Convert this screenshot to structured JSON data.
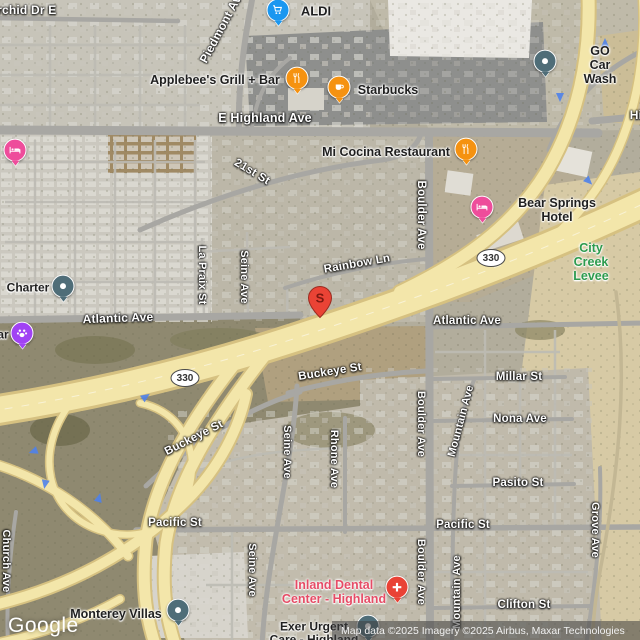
{
  "attribution": {
    "logo_text": "Google",
    "copyright_text": "Map data ©2025 Imagery ©2025 Airbus, Maxar Technologies"
  },
  "marker": {
    "label": "S"
  },
  "route_shield": {
    "text": "330",
    "positions": [
      {
        "x": 185,
        "y": 378
      },
      {
        "x": 491,
        "y": 258
      }
    ]
  },
  "street_labels": [
    {
      "text": "Orchid Dr E",
      "x": 22,
      "y": 10,
      "rot": 0,
      "size": 12
    },
    {
      "text": "Piedmont Ave",
      "x": 222,
      "y": 26,
      "rot": -62,
      "size": 12
    },
    {
      "text": "E Highland Ave",
      "x": 265,
      "y": 118,
      "rot": 0,
      "size": 12.5
    },
    {
      "text": "Hi",
      "x": 636,
      "y": 115,
      "rot": 0,
      "size": 12
    },
    {
      "text": "21st St",
      "x": 252,
      "y": 172,
      "rot": 31,
      "size": 11.5
    },
    {
      "text": "Rainbow Ln",
      "x": 357,
      "y": 264,
      "rot": -10,
      "size": 11.5
    },
    {
      "text": "Boulder Ave",
      "x": 421,
      "y": 215,
      "rot": 90,
      "size": 11.5
    },
    {
      "text": "Atlantic Ave",
      "x": 118,
      "y": 318,
      "rot": -2,
      "size": 12
    },
    {
      "text": "Atlantic Ave",
      "x": 467,
      "y": 321,
      "rot": 0,
      "size": 11.5
    },
    {
      "text": "La Praix St",
      "x": 202,
      "y": 275,
      "rot": 90,
      "size": 11
    },
    {
      "text": "Seine Ave",
      "x": 244,
      "y": 277,
      "rot": 90,
      "size": 11
    },
    {
      "text": "Buckeye St",
      "x": 330,
      "y": 372,
      "rot": -9,
      "size": 11.5
    },
    {
      "text": "Buckeye St",
      "x": 194,
      "y": 438,
      "rot": -27,
      "size": 11.5
    },
    {
      "text": "Millar St",
      "x": 519,
      "y": 377,
      "rot": 0,
      "size": 11.5
    },
    {
      "text": "Nona Ave",
      "x": 520,
      "y": 419,
      "rot": 0,
      "size": 11.5
    },
    {
      "text": "Mountain Ave",
      "x": 461,
      "y": 421,
      "rot": -75,
      "size": 11
    },
    {
      "text": "Pasito St",
      "x": 518,
      "y": 483,
      "rot": 0,
      "size": 11.5
    },
    {
      "text": "Rhone Ave",
      "x": 334,
      "y": 459,
      "rot": 90,
      "size": 11
    },
    {
      "text": "Seine Ave",
      "x": 287,
      "y": 452,
      "rot": 90,
      "size": 11
    },
    {
      "text": "Boulder Ave",
      "x": 421,
      "y": 424,
      "rot": 90,
      "size": 11
    },
    {
      "text": "Pacific St",
      "x": 175,
      "y": 523,
      "rot": 0,
      "size": 11.5
    },
    {
      "text": "Pacific St",
      "x": 463,
      "y": 525,
      "rot": 0,
      "size": 11.5
    },
    {
      "text": "Grove Ave",
      "x": 595,
      "y": 530,
      "rot": 90,
      "size": 11
    },
    {
      "text": "Church Ave",
      "x": 6,
      "y": 561,
      "rot": 90,
      "size": 11
    },
    {
      "text": "Boulder Ave",
      "x": 421,
      "y": 572,
      "rot": 90,
      "size": 11
    },
    {
      "text": "Mountain Ave",
      "x": 457,
      "y": 592,
      "rot": -90,
      "size": 11
    },
    {
      "text": "Clifton St",
      "x": 524,
      "y": 605,
      "rot": 0,
      "size": 11.5
    },
    {
      "text": "Seine Ave",
      "x": 252,
      "y": 570,
      "rot": 90,
      "size": 11
    }
  ],
  "place_labels": [
    {
      "text": "ALDI",
      "x": 316,
      "y": 12,
      "size": 13,
      "color": "#1f1f1f"
    },
    {
      "text": "Applebee's Grill + Bar",
      "x": 215,
      "y": 80,
      "size": 12.5,
      "color": "#1f1f1f"
    },
    {
      "text": "Starbucks",
      "x": 388,
      "y": 90,
      "size": 12.5,
      "color": "#1f1f1f"
    },
    {
      "text": "GO Car Wash",
      "x": 600,
      "y": 65,
      "size": 12.5,
      "color": "#1f1f1f"
    },
    {
      "text": "Mi Cocina Restaurant",
      "x": 386,
      "y": 152,
      "size": 12.5,
      "color": "#1f1f1f"
    },
    {
      "text": "Bear Springs Hotel",
      "x": 557,
      "y": 210,
      "size": 12.5,
      "color": "#1f1f1f"
    },
    {
      "text": "Charter",
      "x": 28,
      "y": 288,
      "size": 12,
      "color": "#1f1f1f"
    },
    {
      "text": "ar",
      "x": 3,
      "y": 335,
      "size": 12,
      "color": "#1f1f1f"
    },
    {
      "text": "City Creek Levee",
      "x": 591,
      "y": 262,
      "size": 12.5,
      "color": "#2d9b4e"
    },
    {
      "text": "Monterey Villas",
      "x": 116,
      "y": 614,
      "size": 12.5,
      "color": "#1f1f1f"
    },
    {
      "text": "Inland Dental\nCenter - Highland",
      "x": 334,
      "y": 592,
      "size": 12.5,
      "color": "#e64c66"
    },
    {
      "text": "Exer Urgent\nCare - Highland",
      "x": 314,
      "y": 634,
      "size": 12,
      "color": "#1f1f1f"
    }
  ],
  "pins": [
    {
      "icon": "shopping-cart",
      "color": "#1a97f0",
      "x": 278,
      "y": 12,
      "place": "ALDI"
    },
    {
      "icon": "restaurant",
      "color": "#f59211",
      "x": 297,
      "y": 80,
      "place": "Applebee's Grill + Bar"
    },
    {
      "icon": "coffee",
      "color": "#f59211",
      "x": 339,
      "y": 89,
      "place": "Starbucks"
    },
    {
      "icon": "place-dot",
      "color": "#4f6d78",
      "x": 545,
      "y": 63,
      "place": "GO Car Wash"
    },
    {
      "icon": "restaurant",
      "color": "#f59211",
      "x": 466,
      "y": 151,
      "place": "Mi Cocina Restaurant"
    },
    {
      "icon": "hotel-bed",
      "color": "#ee4d9b",
      "x": 482,
      "y": 209,
      "place": "Bear Springs Hotel"
    },
    {
      "icon": "place-dot",
      "color": "#4f6d78",
      "x": 63,
      "y": 288,
      "place": "Charter"
    },
    {
      "icon": "paw",
      "color": "#a142f4",
      "x": 22,
      "y": 335,
      "place": "ar"
    },
    {
      "icon": "hotel-bed",
      "color": "#ee4d9b",
      "x": 15,
      "y": 152,
      "place": ""
    },
    {
      "icon": "place-dot",
      "color": "#4f6d78",
      "x": 178,
      "y": 612,
      "place": "Monterey Villas"
    },
    {
      "icon": "medical-cross",
      "color": "#e94235",
      "x": 397,
      "y": 589,
      "place": "Inland Dental Center - Highland"
    },
    {
      "icon": "place-dot",
      "color": "#4f6d78",
      "x": 368,
      "y": 628,
      "place": "Exer Urgent Care - Highland"
    }
  ],
  "arrows": [
    {
      "x": 605,
      "y": 43,
      "rot": 0
    },
    {
      "x": 560,
      "y": 98,
      "rot": 180
    },
    {
      "x": 589,
      "y": 182,
      "rot": 135
    },
    {
      "x": 146,
      "y": 397,
      "rot": 55
    },
    {
      "x": 33,
      "y": 452,
      "rot": 250
    },
    {
      "x": 45,
      "y": 485,
      "rot": 190
    },
    {
      "x": 99,
      "y": 498,
      "rot": 15
    }
  ],
  "colors": {
    "highway_fill": "#f3e6aa",
    "highway_edge": "#d6c181",
    "road_gray": "#a8a7a3",
    "poi_orange": "#f59211",
    "poi_blue": "#1a97f0",
    "poi_pink": "#ee4d9b",
    "poi_slate": "#4f6d78",
    "poi_purple": "#a142f4",
    "poi_red": "#e94235",
    "green_label": "#2d9b4e",
    "dental_red": "#e64c66",
    "marker_red": "#ea4335"
  }
}
